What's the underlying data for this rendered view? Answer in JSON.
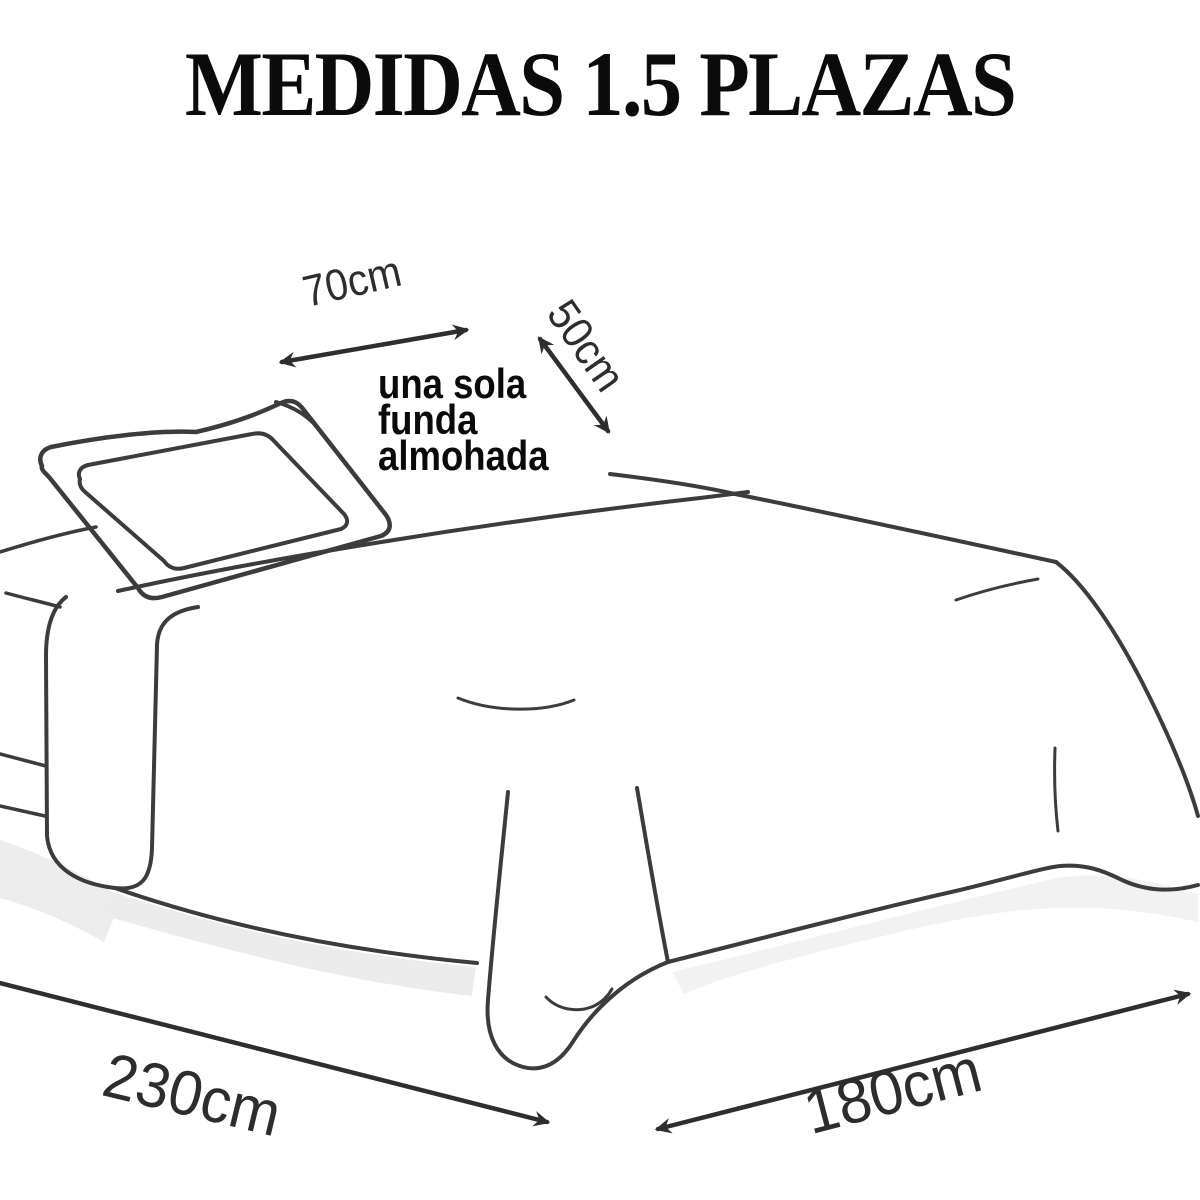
{
  "title": "MEDIDAS 1.5 PLAZAS",
  "note": {
    "line1": "una sola",
    "line2": "funda",
    "line3": "almohada"
  },
  "dimensions": {
    "pillow_width": "70cm",
    "pillow_depth": "50cm",
    "bed_length": "230cm",
    "bed_width": "180cm"
  },
  "colors": {
    "background": "#ffffff",
    "drawing_line": "#3c3c3c",
    "arrow": "#2e2e2e",
    "dimension_text": "#2d2d2d",
    "note_text": "#0a0a0a",
    "title_text": "#0b0b0b",
    "shadow": "#ededed"
  }
}
